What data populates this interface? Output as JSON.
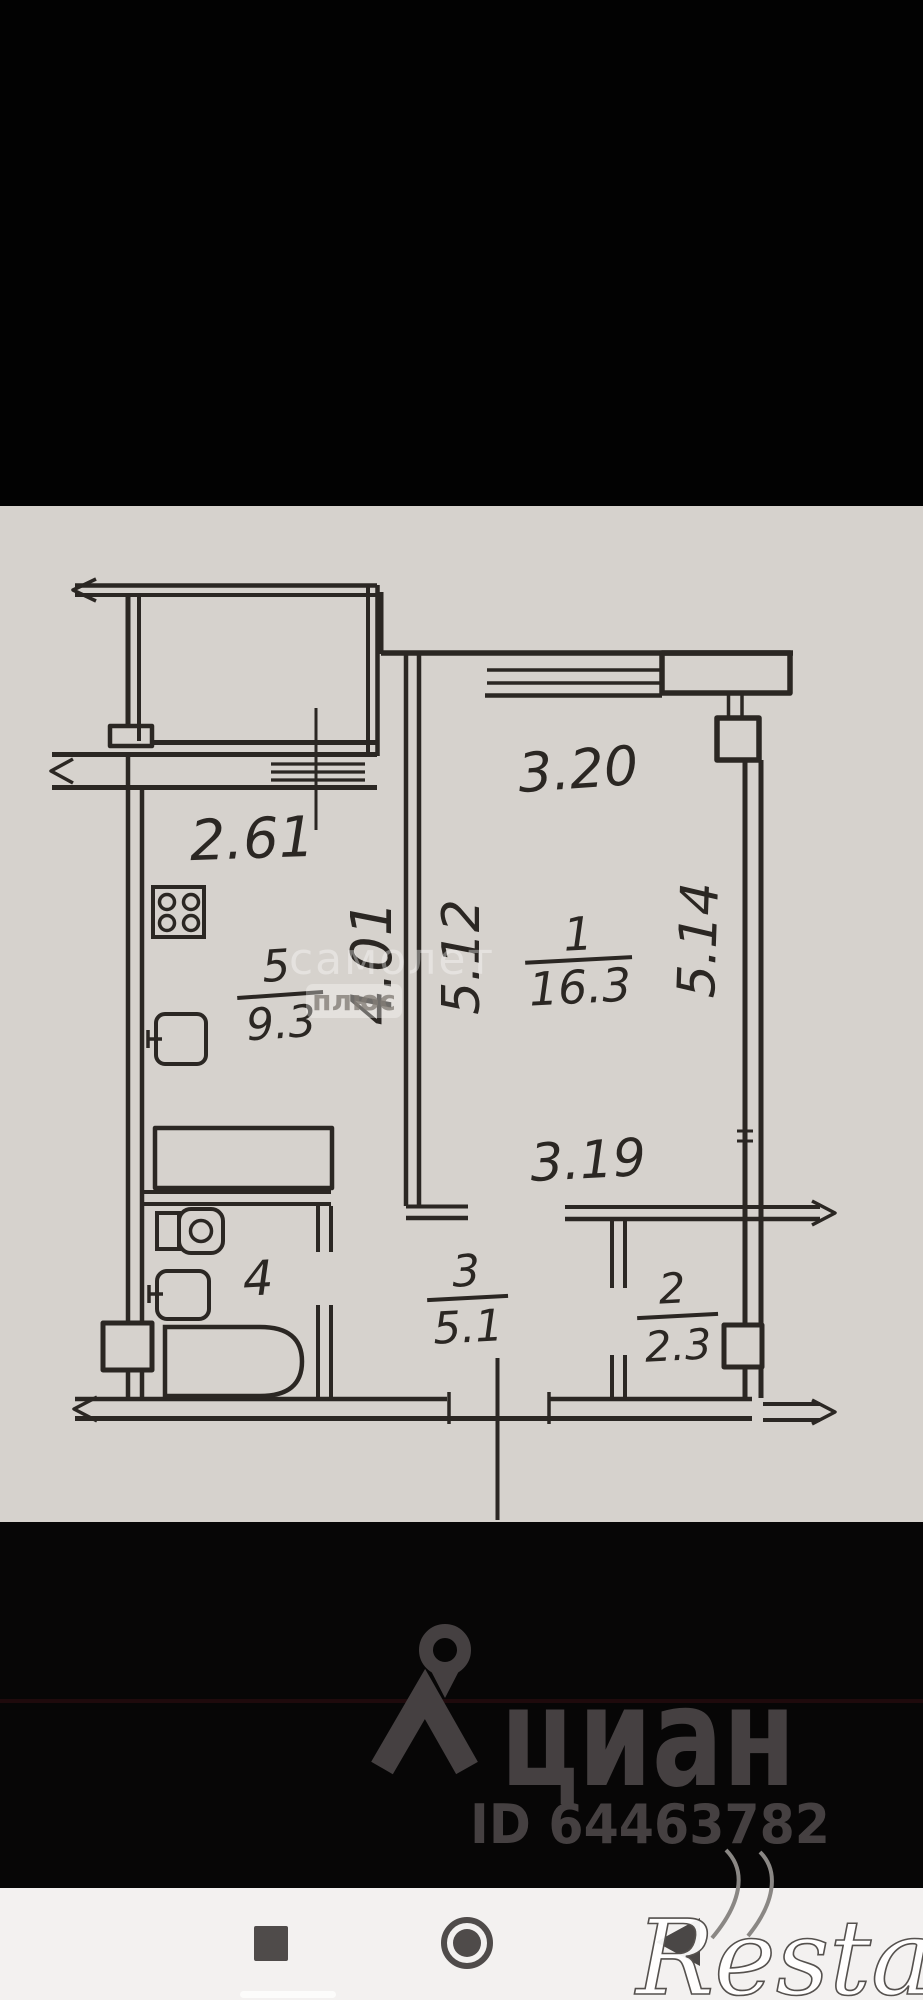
{
  "plan": {
    "rooms": [
      {
        "number": "1",
        "area": "16.3"
      },
      {
        "number": "2",
        "area": "2.3"
      },
      {
        "number": "3",
        "area": "5.1"
      },
      {
        "number": "4",
        "area": ""
      },
      {
        "number": "5",
        "area": "9.3"
      }
    ],
    "dimensions": {
      "kitchen_width": "2.61",
      "room1_width_top": "3.20",
      "room1_width_bottom": "3.19",
      "kitchen_length": "4.01",
      "room1_length_left": "5.12",
      "room1_length_right": "5.14"
    }
  },
  "watermarks": {
    "samolet_top": "самолет",
    "samolet_bottom": "плюс",
    "restate": "Restate"
  },
  "footer": {
    "cian_logo_text": "циан",
    "listing_id": "ID 64463782"
  },
  "navbar": {
    "icons": [
      "recents-square",
      "home-circle",
      "back-triangle"
    ]
  },
  "colors": {
    "plan_background": "#d6d2cd",
    "wall_ink": "#2b2723",
    "logo_gray": "#454041",
    "navbar_background": "#f3f1f0",
    "accent_dark_red": "#260b0e"
  }
}
